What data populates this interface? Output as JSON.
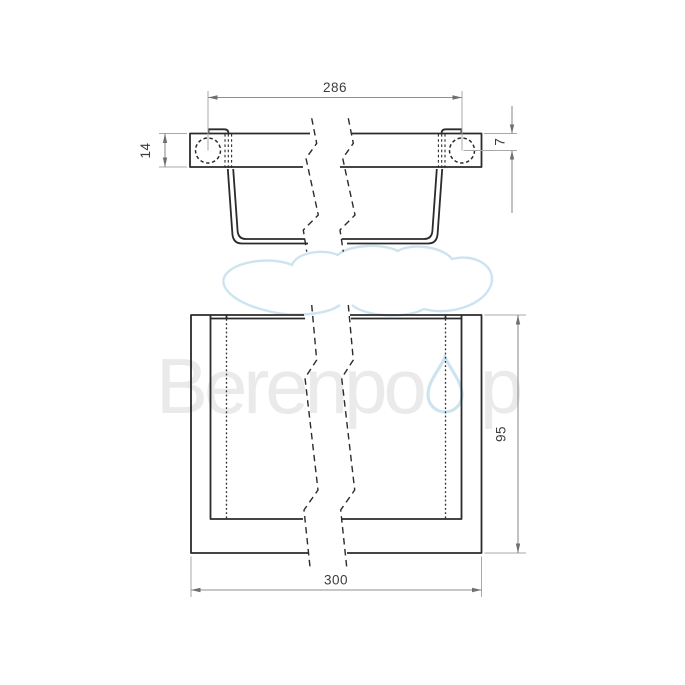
{
  "watermark": {
    "brand_part1": "Berenpo",
    "brand_part2": "p",
    "logo": "cloud-icon",
    "logo2": "water-droplet-icon",
    "text_color": "#eaeaea",
    "accent_color": "#cde4f0"
  },
  "drawing": {
    "background": "#ffffff",
    "object_line_color": "#2b2b2b",
    "dimension_line_color": "#8f8f8f",
    "dimension_text_color": "#3c3c3c",
    "views": {
      "side_view": "broken side elevation of wall bar with hooked rail",
      "plan_view": "broken top plan of rail frame"
    }
  },
  "dims": {
    "hole_spacing": "286",
    "bar_height": "14",
    "hole_top_offset": "7",
    "overall_width": "300",
    "depth": "95"
  }
}
